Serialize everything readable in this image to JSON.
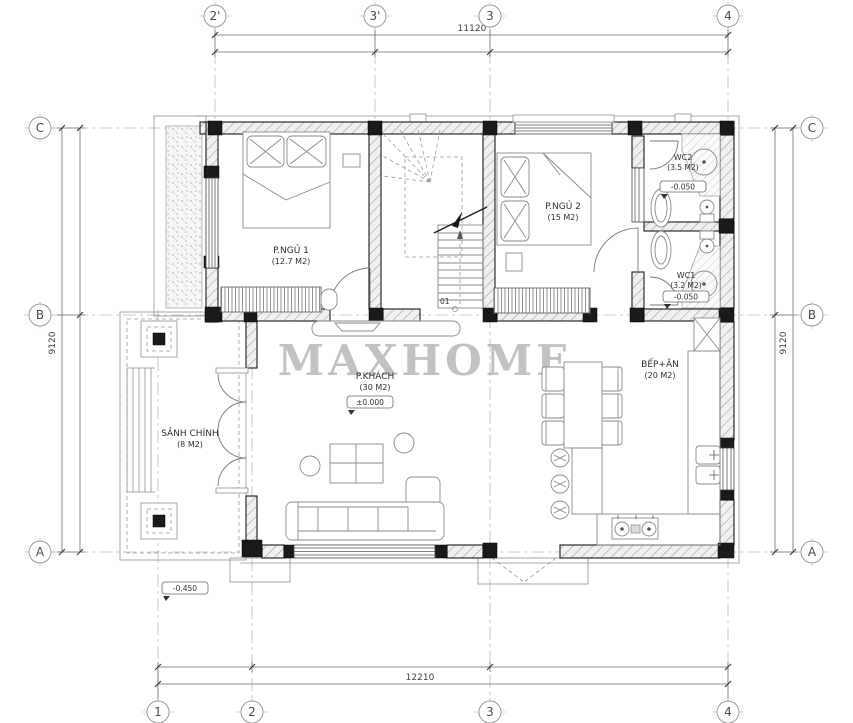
{
  "watermark": "MAXHOME",
  "grid": {
    "top": [
      "2'",
      "3'",
      "3",
      "4"
    ],
    "bottom": [
      "1",
      "2",
      "3",
      "4"
    ],
    "left": [
      "C",
      "B",
      "A"
    ],
    "right": [
      "C",
      "B",
      "A"
    ]
  },
  "dims": {
    "top": "11120",
    "bottom": "12210",
    "left": "9120",
    "right": "9120"
  },
  "rooms": {
    "bedroom1": {
      "name": "P.NGỦ 1",
      "area": "(12.7 M2)"
    },
    "bedroom2": {
      "name": "P.NGỦ 2",
      "area": "(15 M2)"
    },
    "wc2": {
      "name": "WC2",
      "area": "(3.5 M2)",
      "level": "-0.050"
    },
    "wc1": {
      "name": "WC1",
      "area": "(3.2 M2)",
      "level": "-0.050"
    },
    "living": {
      "name": "P.KHÁCH",
      "area": "(30 M2)",
      "level": "±0.000"
    },
    "kitchen": {
      "name": "BẾP+ĂN",
      "area": "(20 M2)"
    },
    "hall": {
      "name": "SẢNH CHÍNH",
      "area": "(8 M2)"
    }
  },
  "levels": {
    "porch": "-0.450"
  },
  "stairs": {
    "label": "01"
  },
  "colors": {
    "wall_outline": "#1a1a1a",
    "wall_hatch": "#9a9a9a",
    "grid_line": "#b9b9b9",
    "text": "#2e2e2e",
    "watermark": "#9a9aa2"
  }
}
